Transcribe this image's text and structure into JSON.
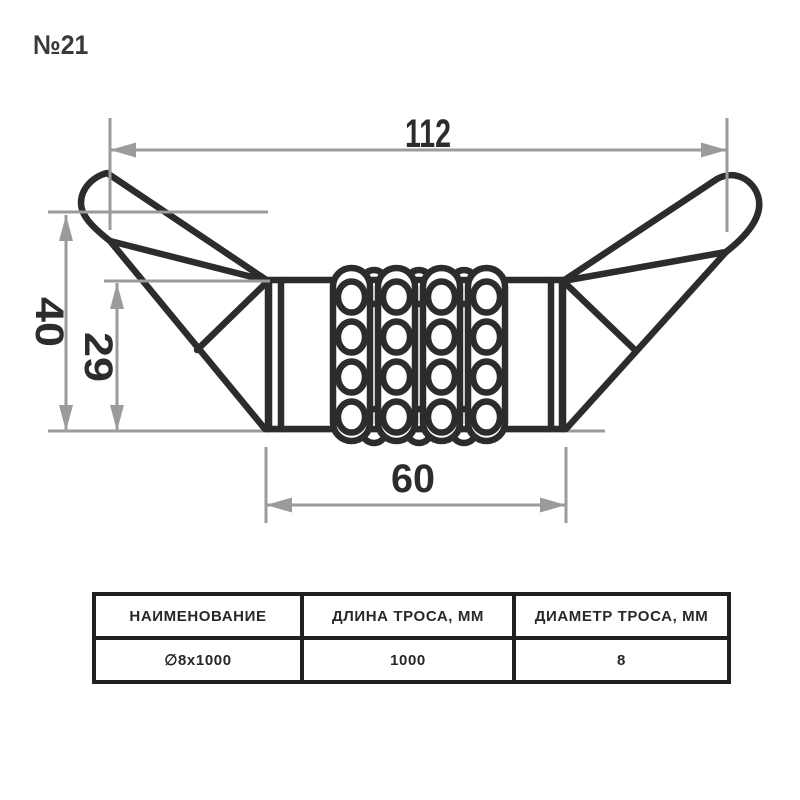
{
  "title": "№21",
  "colors": {
    "background": "#ffffff",
    "outline": "#2c2c2e",
    "dimension": "#9b9b9b",
    "table_border": "#202022"
  },
  "dimensions": {
    "overall_width": "112",
    "overall_height": "40",
    "coil_height": "29",
    "coil_length": "60"
  },
  "table": {
    "headers": [
      "НАИМЕНОВАНИЕ",
      "ДЛИНА ТРОСА, ММ",
      "ДИАМЕТР ТРОСА, ММ"
    ],
    "rows": [
      [
        "∅8x1000",
        "1000",
        "8"
      ]
    ]
  }
}
